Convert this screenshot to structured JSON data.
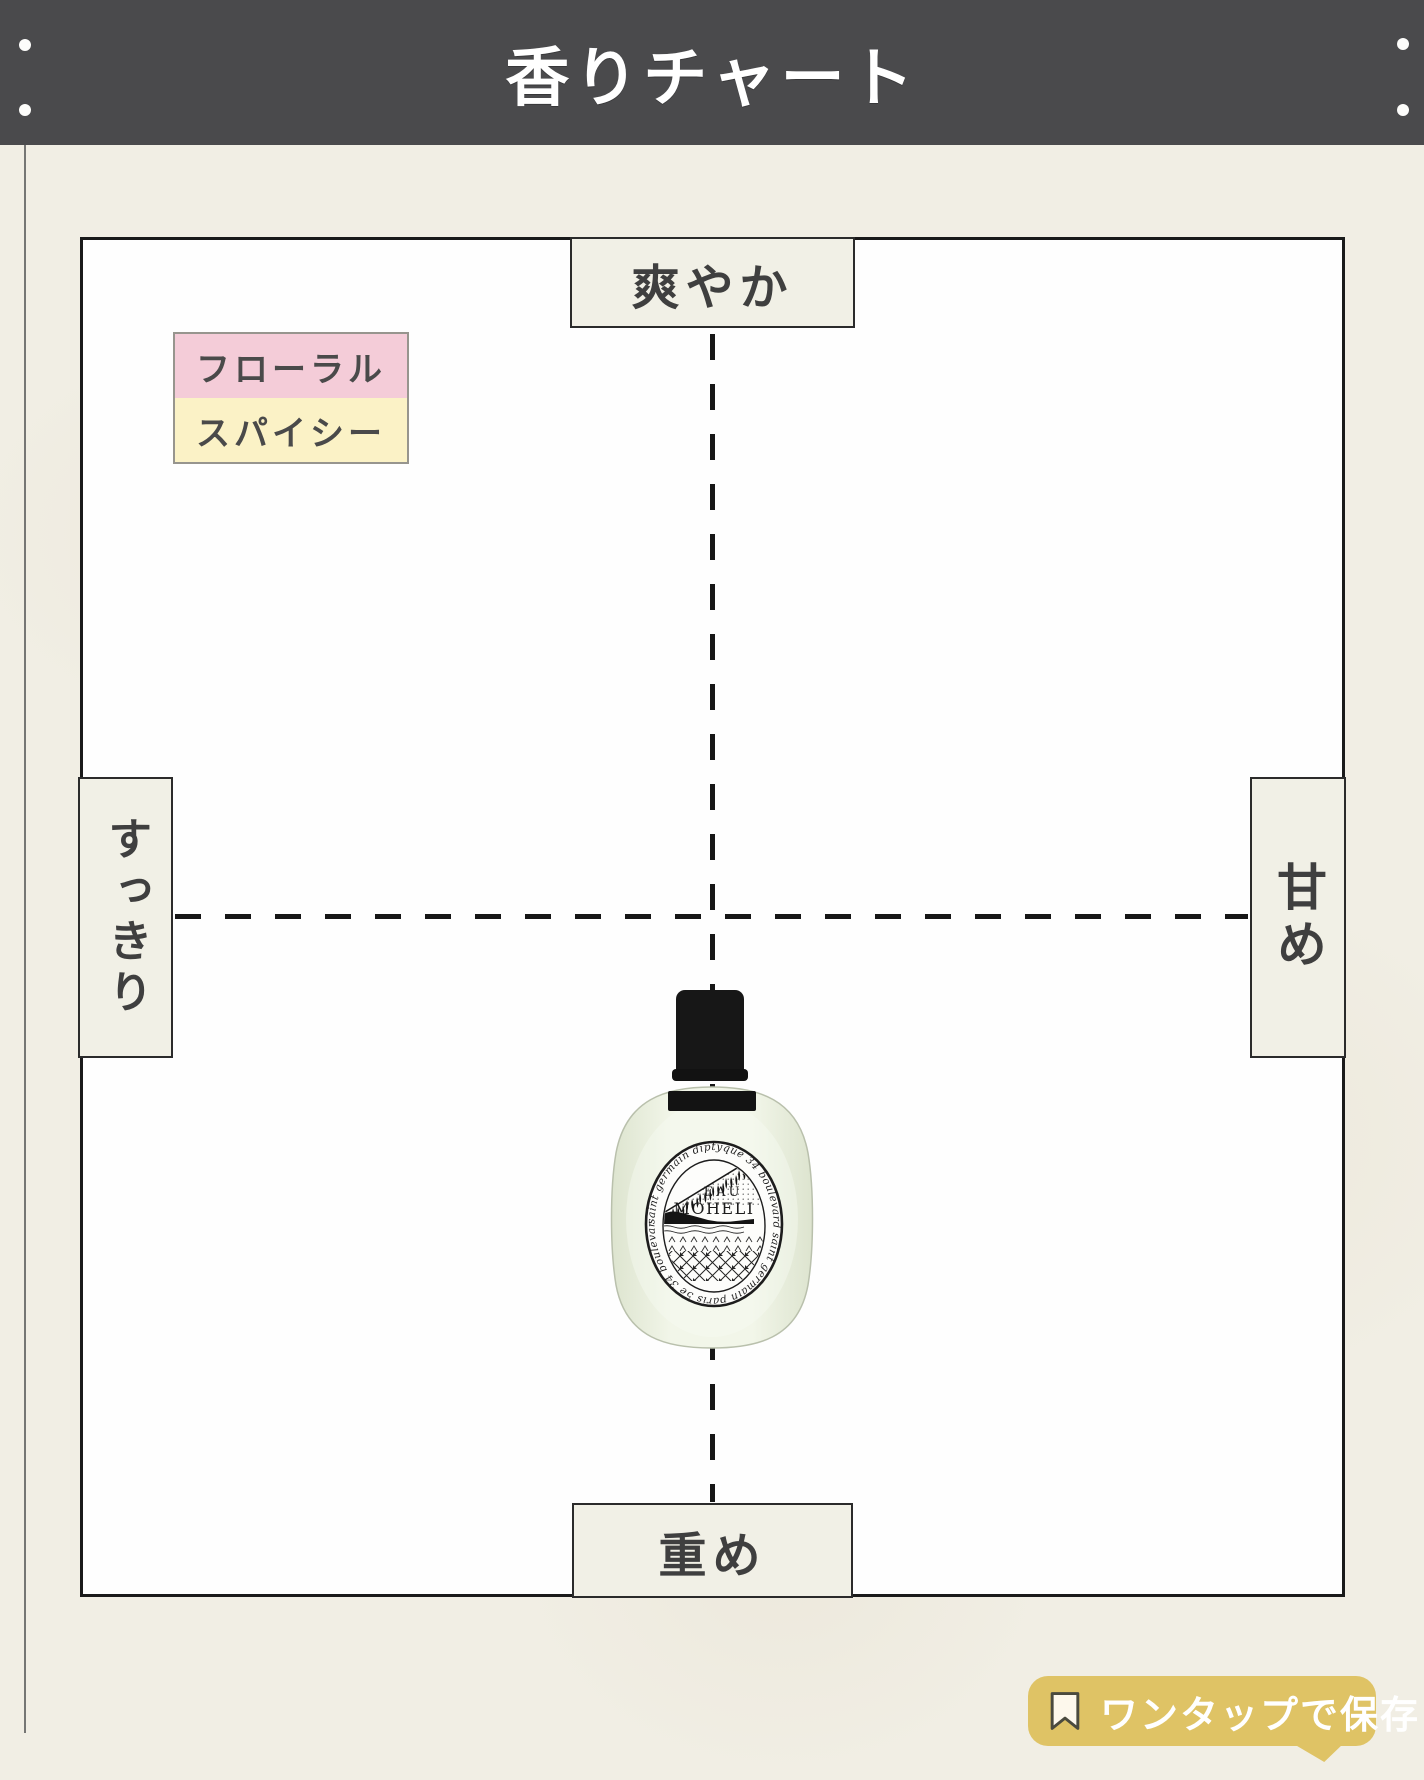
{
  "header": {
    "title": "香りチャート"
  },
  "chart": {
    "axis_labels": {
      "top": "爽やか",
      "bottom": "重め",
      "left": "すっきり",
      "right": "甘め"
    },
    "legend": [
      {
        "label": "フローラル",
        "color": "#f4ccd8"
      },
      {
        "label": "スパイシー",
        "color": "#fbf2c6"
      }
    ]
  },
  "product": {
    "brand": "diptyque",
    "name_line1": "EAU",
    "name_line2": "MOHELI",
    "label_ring_text": "saint germain  diptyque  34 boulevard saint germain  paris 5e  34 boulevard"
  },
  "save_button": {
    "icon": "bookmark-icon",
    "label": "ワンタップで保存！"
  },
  "colors": {
    "header_bg": "#4a4a4c",
    "page_bg": "#f1eee4",
    "chart_bg": "#fefefe",
    "chart_border": "#1a1a1a",
    "axis_box_bg": "#f1f0e6",
    "axis_text": "#3f3f3f",
    "legend_floral": "#f4ccd8",
    "legend_spicy": "#fbf2c6",
    "save_bubble_bg": "#dfc365",
    "bottle_glass": "#eef3e3"
  },
  "chart_data": {
    "type": "scatter",
    "title": "香りチャート",
    "x_axis": {
      "negative_label": "すっきり",
      "positive_label": "甘め",
      "range": [
        -1,
        1
      ]
    },
    "y_axis": {
      "positive_label": "爽やか",
      "negative_label": "重め",
      "range": [
        -1,
        1
      ]
    },
    "grid": "dashed-crosshair",
    "legend_position": "top-left",
    "points": [
      {
        "label": "diptyque EAU MOHELI",
        "x": 0,
        "y": -0.37,
        "tags": [
          "フローラル",
          "スパイシー"
        ]
      }
    ]
  }
}
